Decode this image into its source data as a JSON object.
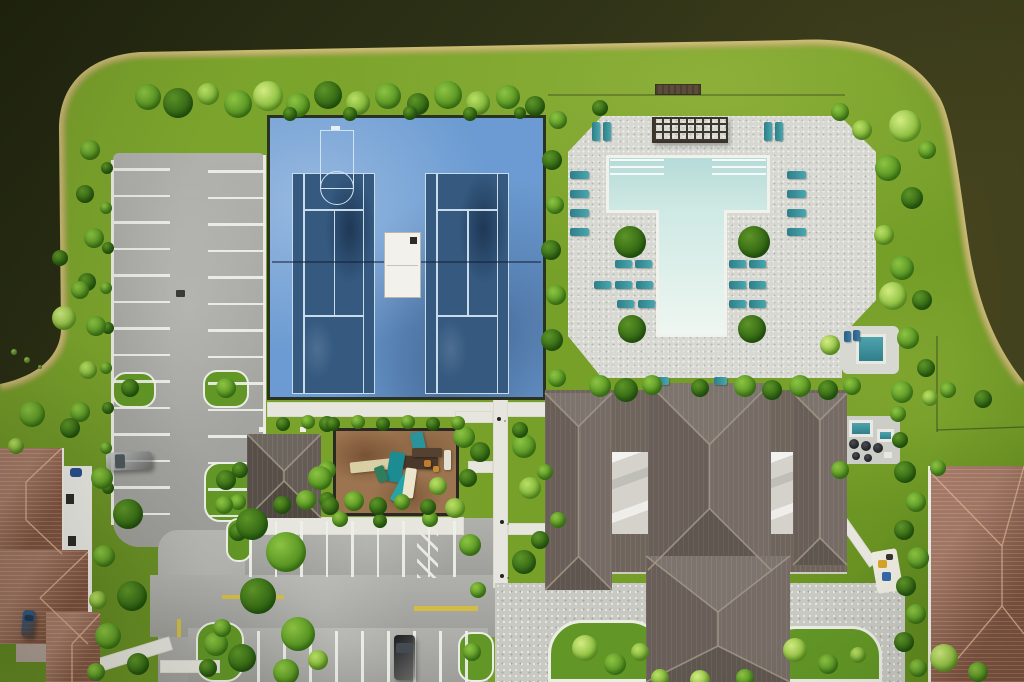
{
  "canvas": {
    "width": 1024,
    "height": 682
  },
  "palette": {
    "water_dark": "#20240f",
    "water_mid": "#2d3116",
    "water_light": "#45441f",
    "sand": "#b9aa66",
    "sand_light": "#d8c87f",
    "grass": "#79a02a",
    "asphalt": "#a7a7a3",
    "stripe": "#eef0e9",
    "court_apron": "#6b9bd2",
    "court_surface": "#35597f",
    "court_line": "#c8dcec",
    "deck": "#d7d8d2",
    "pool_water": "#c2e2de",
    "coping": "#f2f2ec",
    "chair_teal": "#2e7e89",
    "roof_clubhouse": "#6f655d",
    "roof_ridge": "#a39889",
    "roof_house": "#95604a",
    "house_ridge": "#d8ab8e",
    "walk": "#e6e5de",
    "paver": "#c8c9c3",
    "mulch": "#9c7450",
    "yellow": "#d2bc45"
  },
  "vegetation": {
    "trees": [
      [
        148,
        97,
        13,
        "m"
      ],
      [
        178,
        103,
        15,
        "d"
      ],
      [
        208,
        94,
        11,
        "l"
      ],
      [
        238,
        104,
        14,
        "m"
      ],
      [
        268,
        96,
        15,
        "p"
      ],
      [
        298,
        105,
        12,
        "m"
      ],
      [
        328,
        95,
        14,
        "d"
      ],
      [
        358,
        103,
        12,
        "l"
      ],
      [
        388,
        96,
        13,
        "m"
      ],
      [
        418,
        104,
        11,
        "d"
      ],
      [
        448,
        95,
        14,
        "m"
      ],
      [
        478,
        103,
        12,
        "l"
      ],
      [
        508,
        97,
        12,
        "m"
      ],
      [
        535,
        106,
        10,
        "d"
      ],
      [
        290,
        114,
        7,
        "d"
      ],
      [
        350,
        114,
        7,
        "d"
      ],
      [
        410,
        113,
        7,
        "d"
      ],
      [
        470,
        114,
        7,
        "d"
      ],
      [
        520,
        113,
        6,
        "d"
      ],
      [
        558,
        120,
        9,
        "m"
      ],
      [
        552,
        160,
        10,
        "d"
      ],
      [
        555,
        205,
        9,
        "m"
      ],
      [
        551,
        250,
        10,
        "d"
      ],
      [
        556,
        295,
        10,
        "m"
      ],
      [
        552,
        340,
        11,
        "d"
      ],
      [
        557,
        378,
        9,
        "m"
      ],
      [
        600,
        108,
        8,
        "d"
      ],
      [
        840,
        112,
        9,
        "m"
      ],
      [
        862,
        130,
        10,
        "l"
      ],
      [
        905,
        126,
        16,
        "p"
      ],
      [
        927,
        150,
        9,
        "m"
      ],
      [
        888,
        168,
        13,
        "m"
      ],
      [
        912,
        198,
        11,
        "d"
      ],
      [
        884,
        235,
        10,
        "l"
      ],
      [
        902,
        268,
        12,
        "m"
      ],
      [
        922,
        300,
        10,
        "d"
      ],
      [
        893,
        296,
        14,
        "p"
      ],
      [
        908,
        338,
        11,
        "m"
      ],
      [
        926,
        368,
        9,
        "d"
      ],
      [
        902,
        392,
        11,
        "m"
      ],
      [
        930,
        398,
        8,
        "l"
      ],
      [
        948,
        390,
        8,
        "m"
      ],
      [
        983,
        399,
        9,
        "d"
      ],
      [
        830,
        345,
        10,
        "p"
      ],
      [
        600,
        386,
        11,
        "m"
      ],
      [
        626,
        390,
        12,
        "d"
      ],
      [
        652,
        385,
        10,
        "m"
      ],
      [
        700,
        388,
        9,
        "d"
      ],
      [
        745,
        386,
        11,
        "m"
      ],
      [
        772,
        390,
        10,
        "d"
      ],
      [
        800,
        386,
        11,
        "m"
      ],
      [
        828,
        390,
        10,
        "d"
      ],
      [
        852,
        386,
        9,
        "m"
      ],
      [
        630,
        242,
        16,
        "d"
      ],
      [
        754,
        242,
        16,
        "d"
      ],
      [
        632,
        329,
        14,
        "d"
      ],
      [
        752,
        329,
        14,
        "d"
      ],
      [
        524,
        446,
        12,
        "m"
      ],
      [
        480,
        452,
        10,
        "d"
      ],
      [
        530,
        488,
        11,
        "l"
      ],
      [
        470,
        545,
        11,
        "m"
      ],
      [
        524,
        562,
        12,
        "d"
      ],
      [
        478,
        590,
        8,
        "m"
      ],
      [
        520,
        430,
        8,
        "d"
      ],
      [
        545,
        472,
        8,
        "m"
      ],
      [
        540,
        540,
        9,
        "d"
      ],
      [
        558,
        520,
        8,
        "m"
      ],
      [
        464,
        437,
        11,
        "m"
      ],
      [
        468,
        478,
        9,
        "d"
      ],
      [
        455,
        508,
        10,
        "l"
      ],
      [
        327,
        424,
        8,
        "d"
      ],
      [
        340,
        519,
        8,
        "m"
      ],
      [
        380,
        521,
        7,
        "d"
      ],
      [
        430,
        519,
        8,
        "m"
      ],
      [
        240,
        470,
        8,
        "d"
      ],
      [
        238,
        502,
        8,
        "m"
      ],
      [
        327,
        470,
        9,
        "m"
      ],
      [
        327,
        500,
        8,
        "d"
      ],
      [
        282,
        505,
        9,
        "d"
      ],
      [
        306,
        500,
        10,
        "m"
      ],
      [
        330,
        506,
        9,
        "d"
      ],
      [
        354,
        501,
        10,
        "m"
      ],
      [
        378,
        506,
        9,
        "d"
      ],
      [
        402,
        502,
        8,
        "m"
      ],
      [
        428,
        507,
        8,
        "d"
      ],
      [
        320,
        478,
        12,
        "m"
      ],
      [
        438,
        486,
        9,
        "l"
      ],
      [
        283,
        424,
        7,
        "d"
      ],
      [
        308,
        422,
        7,
        "m"
      ],
      [
        333,
        424,
        7,
        "d"
      ],
      [
        358,
        422,
        7,
        "m"
      ],
      [
        383,
        424,
        7,
        "d"
      ],
      [
        408,
        422,
        7,
        "m"
      ],
      [
        433,
        424,
        7,
        "d"
      ],
      [
        458,
        423,
        7,
        "m"
      ],
      [
        107,
        168,
        6,
        "d"
      ],
      [
        106,
        208,
        6,
        "m"
      ],
      [
        108,
        248,
        6,
        "d"
      ],
      [
        106,
        288,
        6,
        "m"
      ],
      [
        108,
        328,
        6,
        "d"
      ],
      [
        106,
        368,
        6,
        "m"
      ],
      [
        108,
        408,
        6,
        "d"
      ],
      [
        106,
        448,
        6,
        "m"
      ],
      [
        108,
        488,
        6,
        "d"
      ],
      [
        90,
        150,
        10,
        "m"
      ],
      [
        85,
        194,
        9,
        "d"
      ],
      [
        94,
        238,
        10,
        "m"
      ],
      [
        87,
        282,
        9,
        "d"
      ],
      [
        96,
        326,
        10,
        "m"
      ],
      [
        88,
        370,
        9,
        "l"
      ],
      [
        80,
        412,
        10,
        "m"
      ],
      [
        64,
        318,
        12,
        "p"
      ],
      [
        80,
        290,
        9,
        "m"
      ],
      [
        60,
        258,
        8,
        "d"
      ],
      [
        32,
        414,
        13,
        "m"
      ],
      [
        70,
        428,
        10,
        "d"
      ],
      [
        16,
        446,
        8,
        "l"
      ],
      [
        130,
        388,
        9,
        "d"
      ],
      [
        226,
        388,
        10,
        "m"
      ],
      [
        226,
        480,
        10,
        "d"
      ],
      [
        224,
        505,
        9,
        "m"
      ],
      [
        238,
        532,
        9,
        "d"
      ],
      [
        216,
        644,
        12,
        "m"
      ],
      [
        208,
        668,
        9,
        "d"
      ],
      [
        472,
        652,
        9,
        "m"
      ],
      [
        252,
        524,
        16,
        "d"
      ],
      [
        286,
        552,
        20,
        "m"
      ],
      [
        258,
        596,
        18,
        "d"
      ],
      [
        298,
        634,
        17,
        "m"
      ],
      [
        242,
        658,
        14,
        "d"
      ],
      [
        286,
        672,
        13,
        "m"
      ],
      [
        318,
        660,
        10,
        "l"
      ],
      [
        222,
        628,
        9,
        "m"
      ],
      [
        102,
        478,
        11,
        "m"
      ],
      [
        128,
        514,
        15,
        "d"
      ],
      [
        104,
        556,
        11,
        "m"
      ],
      [
        132,
        596,
        15,
        "d"
      ],
      [
        108,
        636,
        13,
        "m"
      ],
      [
        138,
        664,
        11,
        "d"
      ],
      [
        98,
        600,
        9,
        "l"
      ],
      [
        96,
        672,
        9,
        "m"
      ],
      [
        585,
        648,
        13,
        "p"
      ],
      [
        615,
        664,
        11,
        "m"
      ],
      [
        640,
        652,
        9,
        "l"
      ],
      [
        795,
        650,
        12,
        "p"
      ],
      [
        828,
        664,
        10,
        "m"
      ],
      [
        858,
        655,
        8,
        "l"
      ],
      [
        660,
        678,
        9,
        "l"
      ],
      [
        700,
        680,
        10,
        "p"
      ],
      [
        745,
        678,
        9,
        "m"
      ],
      [
        905,
        472,
        11,
        "d"
      ],
      [
        916,
        502,
        10,
        "m"
      ],
      [
        904,
        530,
        10,
        "d"
      ],
      [
        918,
        558,
        11,
        "m"
      ],
      [
        906,
        586,
        10,
        "d"
      ],
      [
        916,
        614,
        10,
        "m"
      ],
      [
        904,
        642,
        10,
        "d"
      ],
      [
        918,
        668,
        9,
        "m"
      ],
      [
        944,
        658,
        14,
        "p"
      ],
      [
        978,
        672,
        10,
        "m"
      ],
      [
        938,
        468,
        8,
        "m"
      ],
      [
        840,
        470,
        9,
        "m"
      ],
      [
        900,
        440,
        8,
        "d"
      ],
      [
        898,
        414,
        8,
        "m"
      ],
      [
        14,
        352,
        3,
        "l"
      ],
      [
        27,
        360,
        3,
        "l"
      ],
      [
        40,
        367,
        2,
        "l"
      ]
    ]
  },
  "pool": {
    "chairs": [
      [
        592,
        122,
        8,
        19
      ],
      [
        603,
        122,
        8,
        19
      ],
      [
        764,
        122,
        8,
        19
      ],
      [
        775,
        122,
        8,
        19
      ],
      [
        570,
        171,
        19,
        8
      ],
      [
        570,
        190,
        19,
        8
      ],
      [
        570,
        209,
        19,
        8
      ],
      [
        570,
        228,
        19,
        8
      ],
      [
        787,
        171,
        19,
        8
      ],
      [
        787,
        190,
        19,
        8
      ],
      [
        787,
        209,
        19,
        8
      ],
      [
        787,
        228,
        19,
        8
      ],
      [
        615,
        260,
        17,
        8
      ],
      [
        635,
        260,
        17,
        8
      ],
      [
        594,
        281,
        17,
        8
      ],
      [
        615,
        281,
        17,
        8
      ],
      [
        636,
        281,
        17,
        8
      ],
      [
        617,
        300,
        17,
        8
      ],
      [
        638,
        300,
        17,
        8
      ],
      [
        729,
        260,
        17,
        8
      ],
      [
        749,
        260,
        17,
        8
      ],
      [
        729,
        281,
        17,
        8
      ],
      [
        749,
        281,
        17,
        8
      ],
      [
        729,
        300,
        17,
        8
      ],
      [
        749,
        300,
        17,
        8
      ],
      [
        656,
        377,
        13,
        8
      ],
      [
        714,
        377,
        13,
        8
      ]
    ],
    "spa_chairs": [
      [
        844,
        331,
        7,
        11
      ],
      [
        853,
        330,
        7,
        11
      ]
    ]
  },
  "parking": {
    "stripe_groups": [
      {
        "dir": "h",
        "x": 114,
        "y": 168,
        "len": 56,
        "count": 14,
        "gap": 26.5
      },
      {
        "dir": "h",
        "x": 208,
        "y": 170,
        "len": 57,
        "count": 14,
        "gap": 26.5
      },
      {
        "dir": "v",
        "x": 249,
        "y": 521,
        "len": 56,
        "count": 9,
        "gap": 25.5
      },
      {
        "dir": "v",
        "x": 257,
        "y": 631,
        "len": 51,
        "count": 9,
        "gap": 26
      }
    ],
    "yellow_markings": [
      [
        222,
        595,
        62,
        4
      ],
      [
        414,
        606,
        64,
        5
      ],
      [
        177,
        619,
        4,
        18
      ]
    ],
    "hatch": {
      "x": 417,
      "y": 523,
      "w": 21,
      "h": 55
    },
    "drains": [
      [
        176,
        290,
        9,
        7
      ],
      [
        552,
        566,
        7,
        6
      ]
    ]
  },
  "amenities": {
    "grills": [
      [
        854,
        444,
        5
      ],
      [
        866,
        446,
        5
      ],
      [
        878,
        448,
        5
      ],
      [
        856,
        456,
        4
      ],
      [
        868,
        458,
        4
      ]
    ],
    "cars": [
      {
        "name": "silver-car",
        "x": 106,
        "y": 452,
        "w": 46,
        "h": 18,
        "rot": -2,
        "body": "#c3c6c8",
        "glass": "#4e565c"
      },
      {
        "name": "black-car",
        "x": 394,
        "y": 635,
        "w": 21,
        "h": 45,
        "rot": 0,
        "body": "#1b1d20",
        "glass": "#454b52"
      },
      {
        "name": "blue-car",
        "x": 22,
        "y": 610,
        "w": 13,
        "h": 27,
        "rot": 5,
        "body": "#2c5c8f",
        "glass": "#1c3a5c"
      }
    ]
  },
  "roofs": {
    "clubhouse_sections": [
      {
        "x": 545,
        "y": 393,
        "w": 67,
        "h": 197
      },
      {
        "x": 648,
        "y": 383,
        "w": 123,
        "h": 187
      },
      {
        "x": 793,
        "y": 393,
        "w": 54,
        "h": 172
      },
      {
        "x": 646,
        "y": 556,
        "w": 144,
        "h": 126,
        "r1": 612,
        "r2": 646
      },
      {
        "x": 247,
        "y": 434,
        "w": 74,
        "h": 84,
        "color": "#5d554c"
      }
    ]
  }
}
